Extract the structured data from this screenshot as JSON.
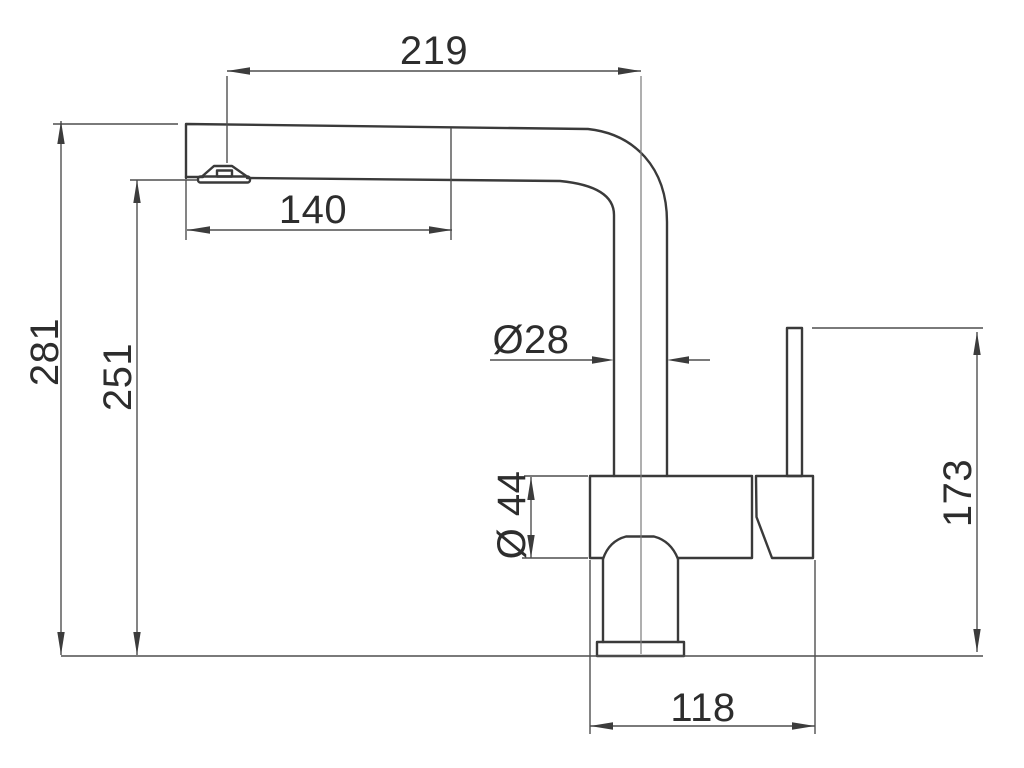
{
  "drawing": {
    "kind": "technical-dimension-drawing",
    "subject": "kitchen-faucet-side-elevation",
    "units": "mm",
    "colors": {
      "background": "#ffffff",
      "outline": "#3a3a3a",
      "dimension_lines": "#4f4f4f",
      "text": "#2d2d2d"
    },
    "dims": {
      "spout_reach": "219",
      "spray_head_length": "140",
      "tube_diameter": "Ø28",
      "body_diameter": "Ø 44",
      "overall_height": "281",
      "outlet_height": "251",
      "lever_height": "173",
      "base_depth": "118"
    }
  }
}
